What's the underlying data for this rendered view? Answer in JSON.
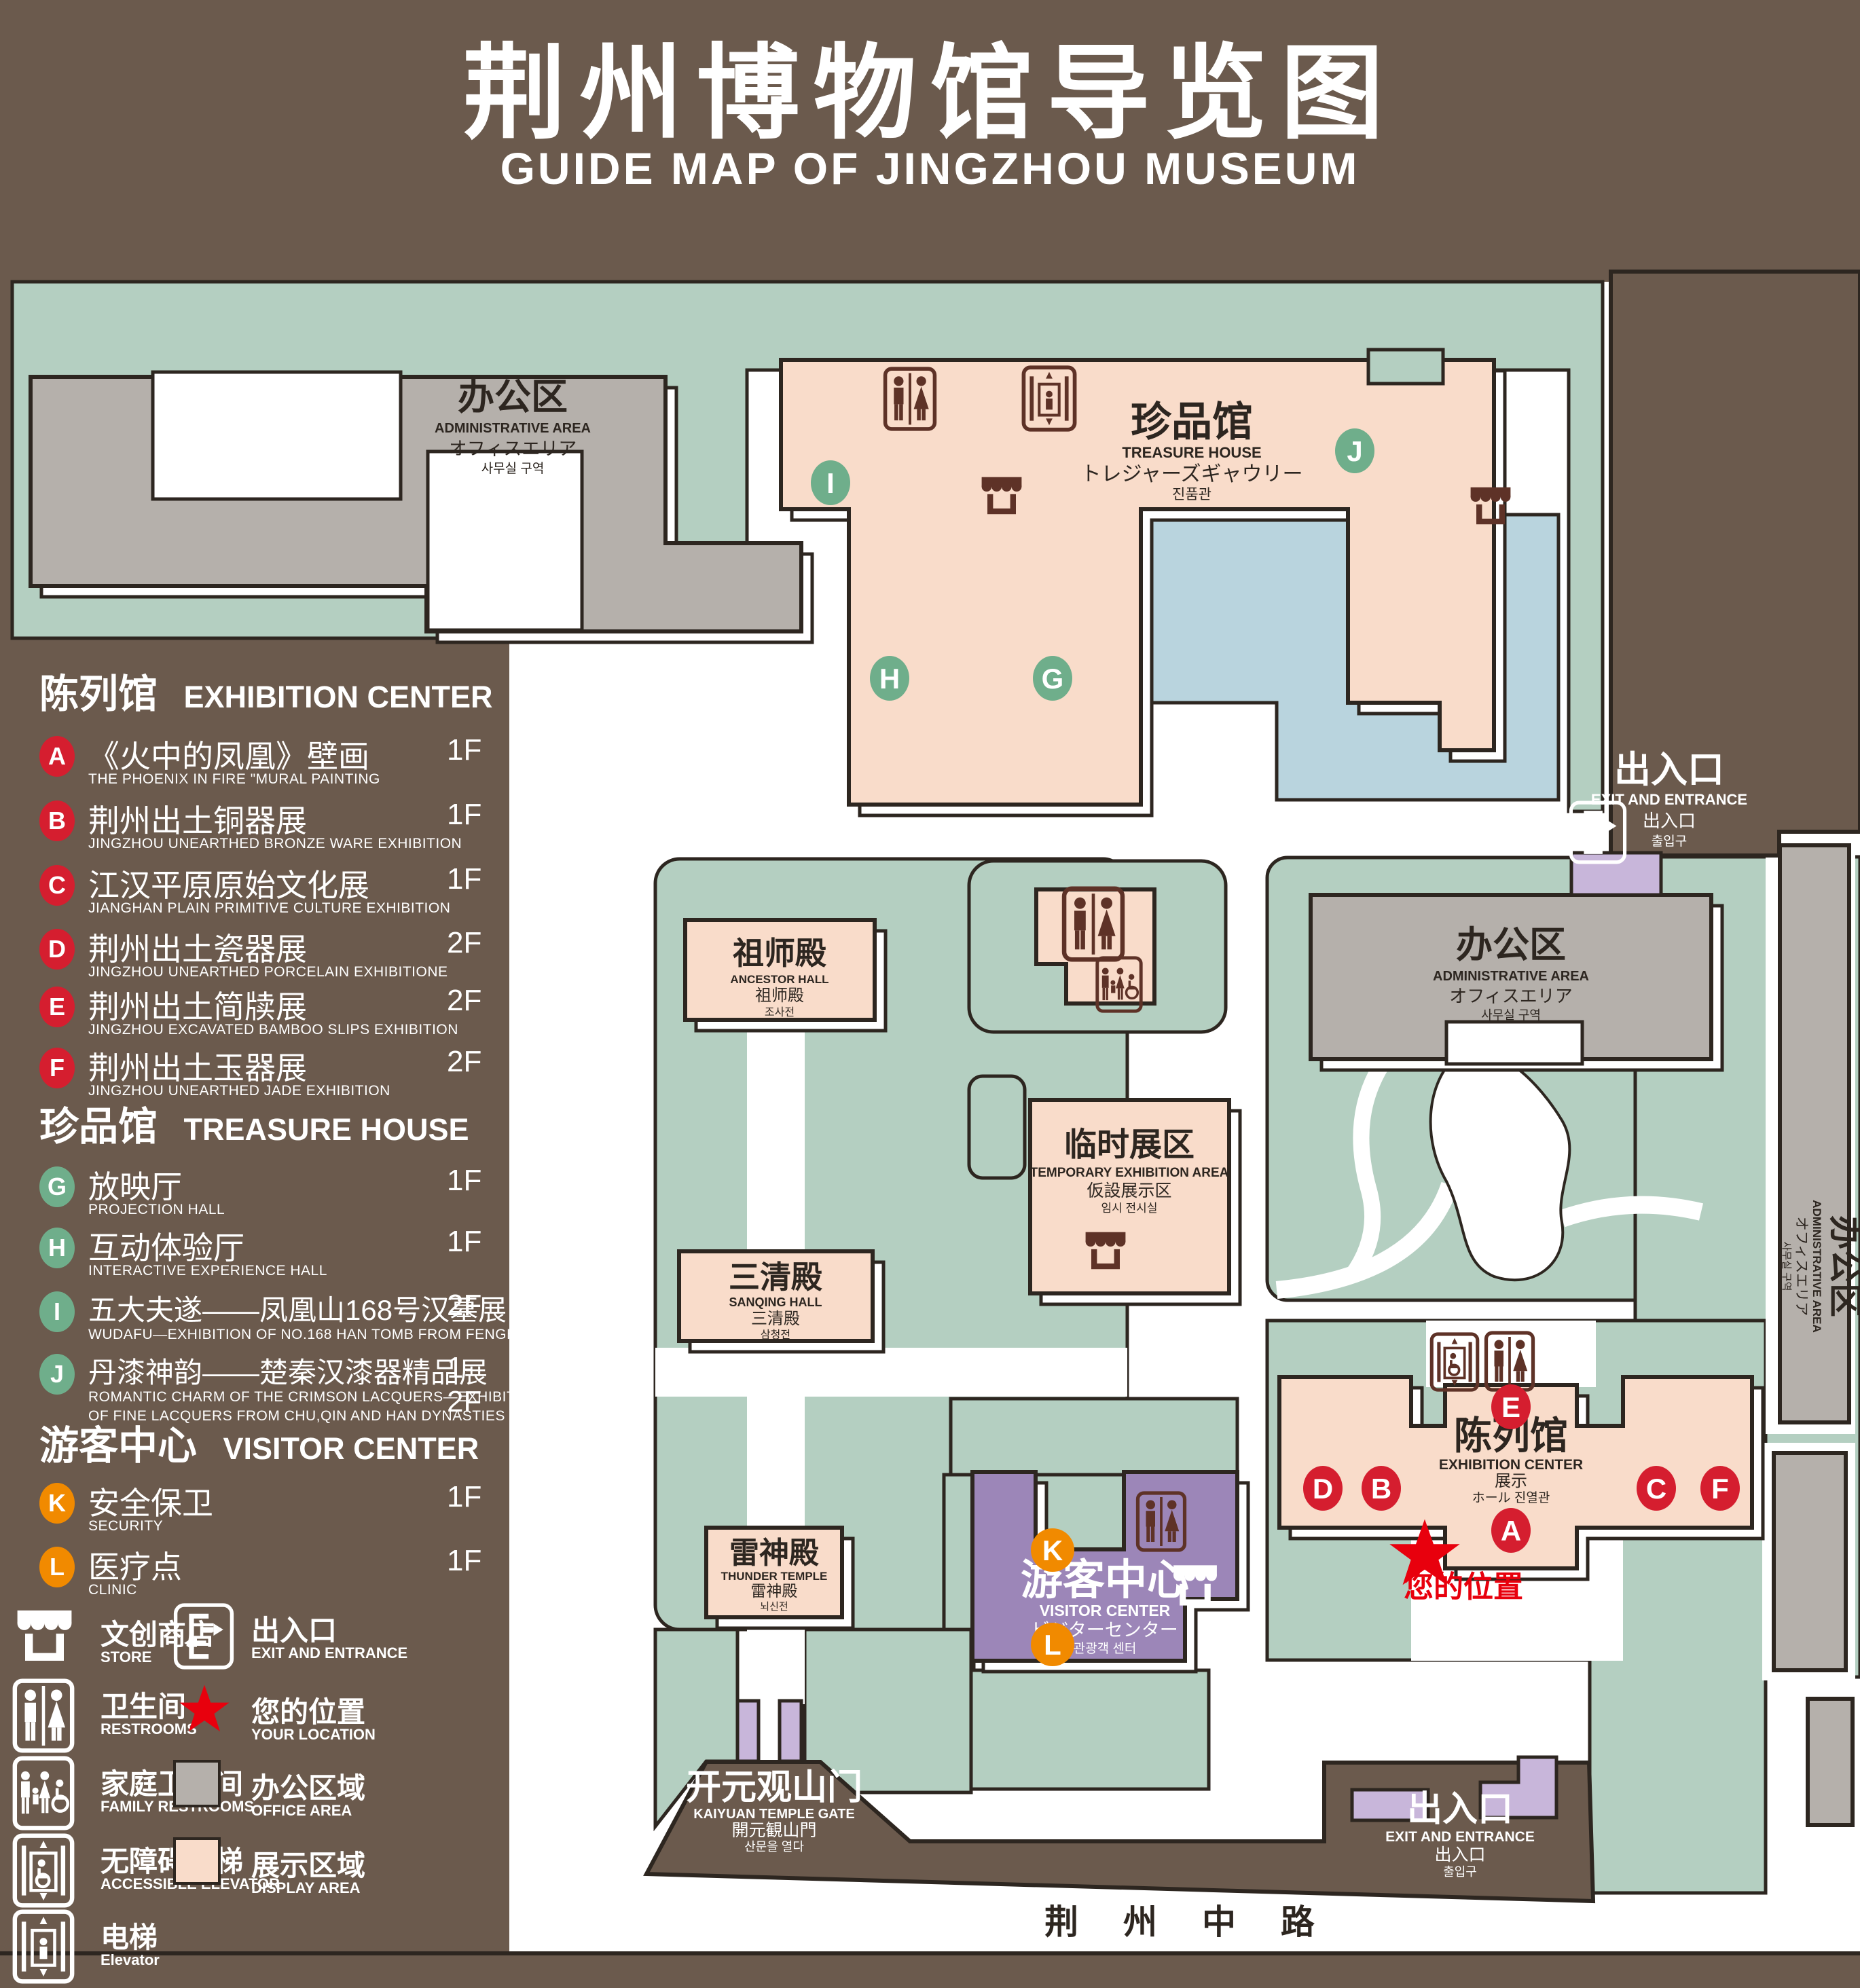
{
  "title": {
    "cn": "荆州博物馆导览图",
    "en": "GUIDE MAP OF JINGZHOU MUSEUM"
  },
  "colors": {
    "background": "#6b5a4d",
    "green_area": "#b4cfc1",
    "display_area": "#f9dcca",
    "office_area": "#b5b0ab",
    "visitor_center": "#9c86b8",
    "light_purple": "#c8b6da",
    "water": "#b9d4de",
    "outline": "#2d2620",
    "badge_red": "#d51e2f",
    "badge_green": "#6fae8b",
    "badge_orange": "#f18a00",
    "icon_maroon": "#5e3227",
    "location_red": "#e8000d"
  },
  "sidebar": {
    "sections": [
      {
        "cn": "陈列馆",
        "en": "EXHIBITION CENTER",
        "items": [
          {
            "letter": "A",
            "cn": "《火中的凤凰》壁画",
            "en": "THE PHOENIX IN FIRE \"MURAL PAINTING",
            "floor": "1F"
          },
          {
            "letter": "B",
            "cn": "荆州出土铜器展",
            "en": "JINGZHOU UNEARTHED BRONZE WARE EXHIBITION",
            "floor": "1F"
          },
          {
            "letter": "C",
            "cn": "江汉平原原始文化展",
            "en": "JIANGHAN PLAIN PRIMITIVE CULTURE EXHIBITION",
            "floor": "1F"
          },
          {
            "letter": "D",
            "cn": "荆州出土瓷器展",
            "en": "JINGZHOU UNEARTHED PORCELAIN EXHIBITIONE",
            "floor": "2F"
          },
          {
            "letter": "E",
            "cn": "荆州出土简牍展",
            "en": "JINGZHOU EXCAVATED BAMBOO SLIPS EXHIBITION",
            "floor": "2F"
          },
          {
            "letter": "F",
            "cn": "荆州出土玉器展",
            "en": "JINGZHOU UNEARTHED JADE EXHIBITION",
            "floor": "2F"
          }
        ]
      },
      {
        "cn": "珍品馆",
        "en": "TREASURE HOUSE",
        "items": [
          {
            "letter": "G",
            "cn": "放映厅",
            "en": "PROJECTION HALL",
            "floor": "1F"
          },
          {
            "letter": "H",
            "cn": "互动体验厅",
            "en": "INTERACTIVE EXPERIENCE HALL",
            "floor": "1F"
          },
          {
            "letter": "I",
            "cn": "五大夫遂——凤凰山168号汉墓展",
            "en": "WUDAFU—EXHIBITION OF NO.168 HAN TOMB FROM FENGHUANGSHAN",
            "floor": "2F"
          },
          {
            "letter": "J",
            "cn": "丹漆神韵——楚秦汉漆器精品展",
            "en": "ROMANTIC CHARM OF THE CRIMSON LACQUERS—EXHIBITIONS",
            "en2": "OF FINE LACQUERS FROM CHU,QIN AND HAN DYNASTIES",
            "floor": "1-2F"
          }
        ]
      },
      {
        "cn": "游客中心",
        "en": "VISITOR CENTER",
        "items": [
          {
            "letter": "K",
            "cn": "安全保卫",
            "en": "SECURITY",
            "floor": "1F"
          },
          {
            "letter": "L",
            "cn": "医疗点",
            "en": "CLINIC",
            "floor": "1F"
          }
        ]
      }
    ],
    "legend": [
      {
        "cn": "文创商店",
        "en": "STORE"
      },
      {
        "cn": "出入口",
        "en": "EXIT AND ENTRANCE"
      },
      {
        "cn": "卫生间",
        "en": "RESTROOMS"
      },
      {
        "cn": "您的位置",
        "en": "YOUR LOCATION"
      },
      {
        "cn": "家庭卫生间",
        "en": "FAMILY RESTROOMS"
      },
      {
        "cn": "办公区域",
        "en": "OFFICE AREA"
      },
      {
        "cn": "无障碍电梯",
        "en": "ACCESSIBLE ELEVATOR"
      },
      {
        "cn": "展示区域",
        "en": "DISPLAY AREA"
      },
      {
        "cn": "电梯",
        "en": "Elevator"
      }
    ]
  },
  "map": {
    "admin_tl": {
      "cn": "办公区",
      "en": "ADMINISTRATIVE AREA",
      "jp": "オフィスエリア",
      "kr": "사무실 구역"
    },
    "admin_right": {
      "cn": "办公区",
      "en": "ADMINISTRATIVE AREA",
      "jp": "オフィスエリア",
      "kr": "사무실 구역"
    },
    "admin_strip": {
      "cn": "办公区",
      "en": "ADMINISTRATIVE AREA",
      "jp": "オフィスエリア",
      "kr": "사무실 구역"
    },
    "treasure": {
      "cn": "珍品馆",
      "en": "TREASURE HOUSE",
      "jp": "トレジャーズギャウリー",
      "kr": "진품관"
    },
    "ancestor": {
      "cn": "祖师殿",
      "en": "ANCESTOR HALL",
      "jp": "祖师殿",
      "kr": "조사전"
    },
    "temp": {
      "cn": "临时展区",
      "en": "TEMPORARY EXHIBITION AREA",
      "jp": "仮設展示区",
      "kr": "임시 전시실"
    },
    "sanqing": {
      "cn": "三清殿",
      "en": "SANQING HALL",
      "jp": "三清殿",
      "kr": "삼청전"
    },
    "thunder": {
      "cn": "雷神殿",
      "en": "THUNDER TEMPLE",
      "jp": "雷神殿",
      "kr": "뇌신전"
    },
    "visitor": {
      "cn": "游客中心",
      "en": "VISITOR CENTER",
      "jp": "ビジターセンター",
      "kr": "관광객 센터"
    },
    "exhibition": {
      "cn": "陈列馆",
      "en": "EXHIBITION CENTER",
      "jp": "展示",
      "jp2": "ホール 진열관"
    },
    "exit_top": {
      "cn": "出入口",
      "en": "EXIT AND ENTRANCE",
      "jp": "出入口",
      "kr": "출입구"
    },
    "exit_bottom": {
      "cn": "出入口",
      "en": "EXIT AND ENTRANCE",
      "jp": "出入口",
      "kr": "출입구"
    },
    "gate": {
      "cn": "开元观山门",
      "en": "KAIYUAN TEMPLE GATE",
      "jp": "開元観山門",
      "kr": "산문을 열다"
    },
    "road": "荆 州 中 路",
    "your_location": "您的位置",
    "badges": {
      "a": "A",
      "b": "B",
      "c": "C",
      "d": "D",
      "e": "E",
      "f": "F",
      "g": "G",
      "h": "H",
      "i": "I",
      "j": "J",
      "k": "K",
      "l": "L"
    }
  }
}
